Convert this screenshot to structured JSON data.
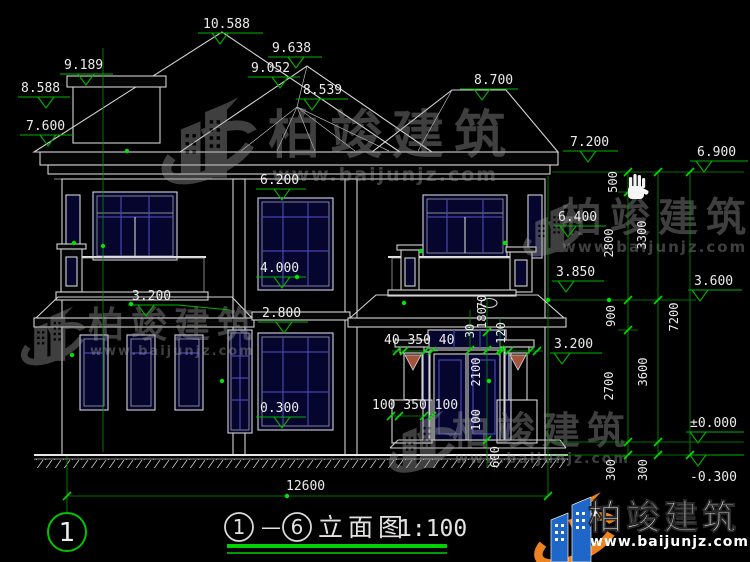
{
  "colors": {
    "background": "#000000",
    "line_white": "#d4d4d4",
    "dimension_green": "#00b400",
    "grip_green": "#00e400",
    "window_navy": "#05052e",
    "mullion_blue": "#4646ab",
    "railing_brown": "#9a5242",
    "logo_blue": "#1e66c8",
    "logo_orange": "#ee8220"
  },
  "watermark": {
    "brand": "柏竣建筑",
    "url": "www.baijunjz.com"
  },
  "axis": {
    "bubble": "1"
  },
  "title": {
    "axis_start": "1",
    "separator": "—",
    "axis_end": "6",
    "name": "立面图",
    "scale": "1:100"
  },
  "dims": {
    "levels": {
      "d10588": "10.588",
      "d9638": "9.638",
      "d9052": "9.052",
      "d8539": "8.539",
      "d9189": "9.189",
      "d8588": "8.588",
      "d7600": "7.600",
      "d8700": "8.700",
      "d7200": "7.200",
      "d6900": "6.900",
      "d6200": "6.200",
      "d4000": "4.000",
      "d2800": "2.800",
      "d3200L": "3.200",
      "d0300": "0.300",
      "d6400": "6.400",
      "d3850": "3.850",
      "d3600": "3.600",
      "d3200R": "3.200",
      "d0000": "±0.000",
      "dm0300": "-0.300"
    },
    "chain_inner": [
      "500",
      "2800",
      "900",
      "2700",
      "300"
    ],
    "chain_mid": [
      "3300",
      "3600",
      "300"
    ],
    "chain_outer": [
      "7200"
    ],
    "porch": {
      "capital": "40 350 40",
      "base": "100 350 100",
      "door_height": "2100",
      "h100": "100",
      "h600": "600",
      "s30": "30",
      "s180": "180",
      "s70": "70",
      "s120": "120"
    },
    "overall_width": "12600"
  }
}
